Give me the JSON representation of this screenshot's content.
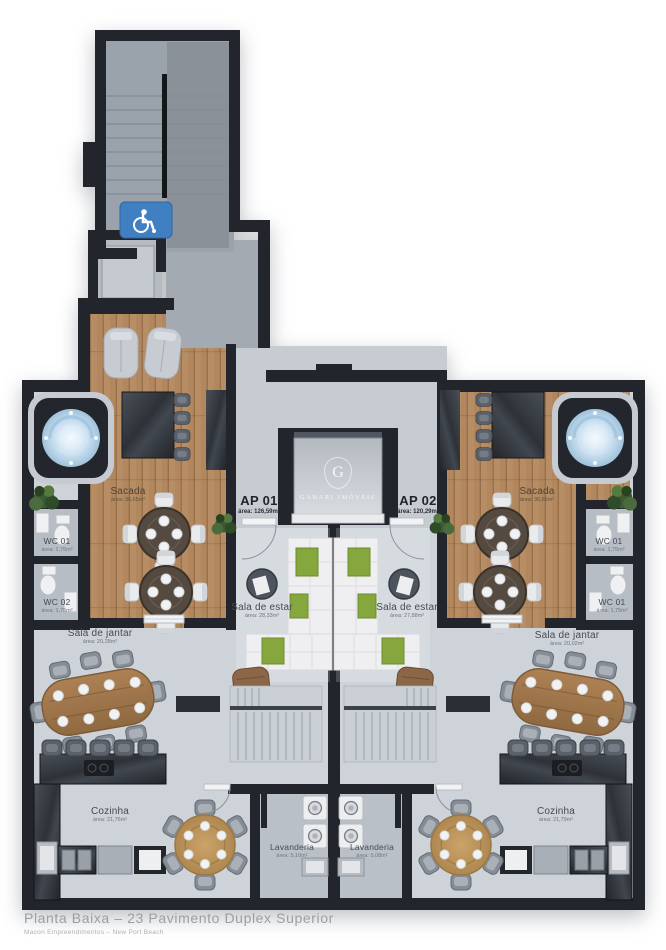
{
  "title_block": {
    "title": "Planta Baixa – 23 Pavimento Duplex Superior",
    "subtitle": "Macon Empreendimentos – New Port Beach"
  },
  "watermark": {
    "initial": "G",
    "name": "GABARI IMÓVEIS"
  },
  "apartments": [
    {
      "id": "ap01",
      "name": "AP 01",
      "area": "área: 126,59m²"
    },
    {
      "id": "ap02",
      "name": "AP 02",
      "area": "área: 120,29m²"
    }
  ],
  "rooms": [
    {
      "id": "sacada-left",
      "name": "Sacada",
      "area": "área: 36,65m²"
    },
    {
      "id": "sacada-right",
      "name": "Sacada",
      "area": "área: 36,65m²"
    },
    {
      "id": "wc01-left",
      "name": "WC 01",
      "area": "área: 1,75m²"
    },
    {
      "id": "wc02-left",
      "name": "WC 02",
      "area": "área: 1,75m²"
    },
    {
      "id": "wc01-right-upper",
      "name": "WC 01",
      "area": "área: 1,75m²"
    },
    {
      "id": "wc01-right-lower",
      "name": "WC 01",
      "area": "área: 1,75m²"
    },
    {
      "id": "sala-estar-left",
      "name": "Sala de estar",
      "area": "área: 28,33m²"
    },
    {
      "id": "sala-estar-right",
      "name": "Sala de estar",
      "area": "área: 27,88m²"
    },
    {
      "id": "sala-jantar-left",
      "name": "Sala de jantar",
      "area": "área: 20,28m²"
    },
    {
      "id": "sala-jantar-right",
      "name": "Sala de jantar",
      "area": "área: 20,02m²"
    },
    {
      "id": "cozinha-left",
      "name": "Cozinha",
      "area": "área: 21,76m²"
    },
    {
      "id": "cozinha-right",
      "name": "Cozinha",
      "area": "área: 21,79m²"
    },
    {
      "id": "lavanderia-left",
      "name": "Lavanderia",
      "area": "área: 5,10m²"
    },
    {
      "id": "lavanderia-right",
      "name": "Lavanderia",
      "area": "área: 5,08m²"
    }
  ],
  "icons": {
    "wheelchair": "wheelchair-accessible"
  },
  "colors": {
    "wall": "#22262c",
    "floor": "#ced3da",
    "wood": "#b2875d",
    "accent_green": "#85a73e",
    "water": "#cfe4f4",
    "sign_blue": "#4080c2"
  }
}
